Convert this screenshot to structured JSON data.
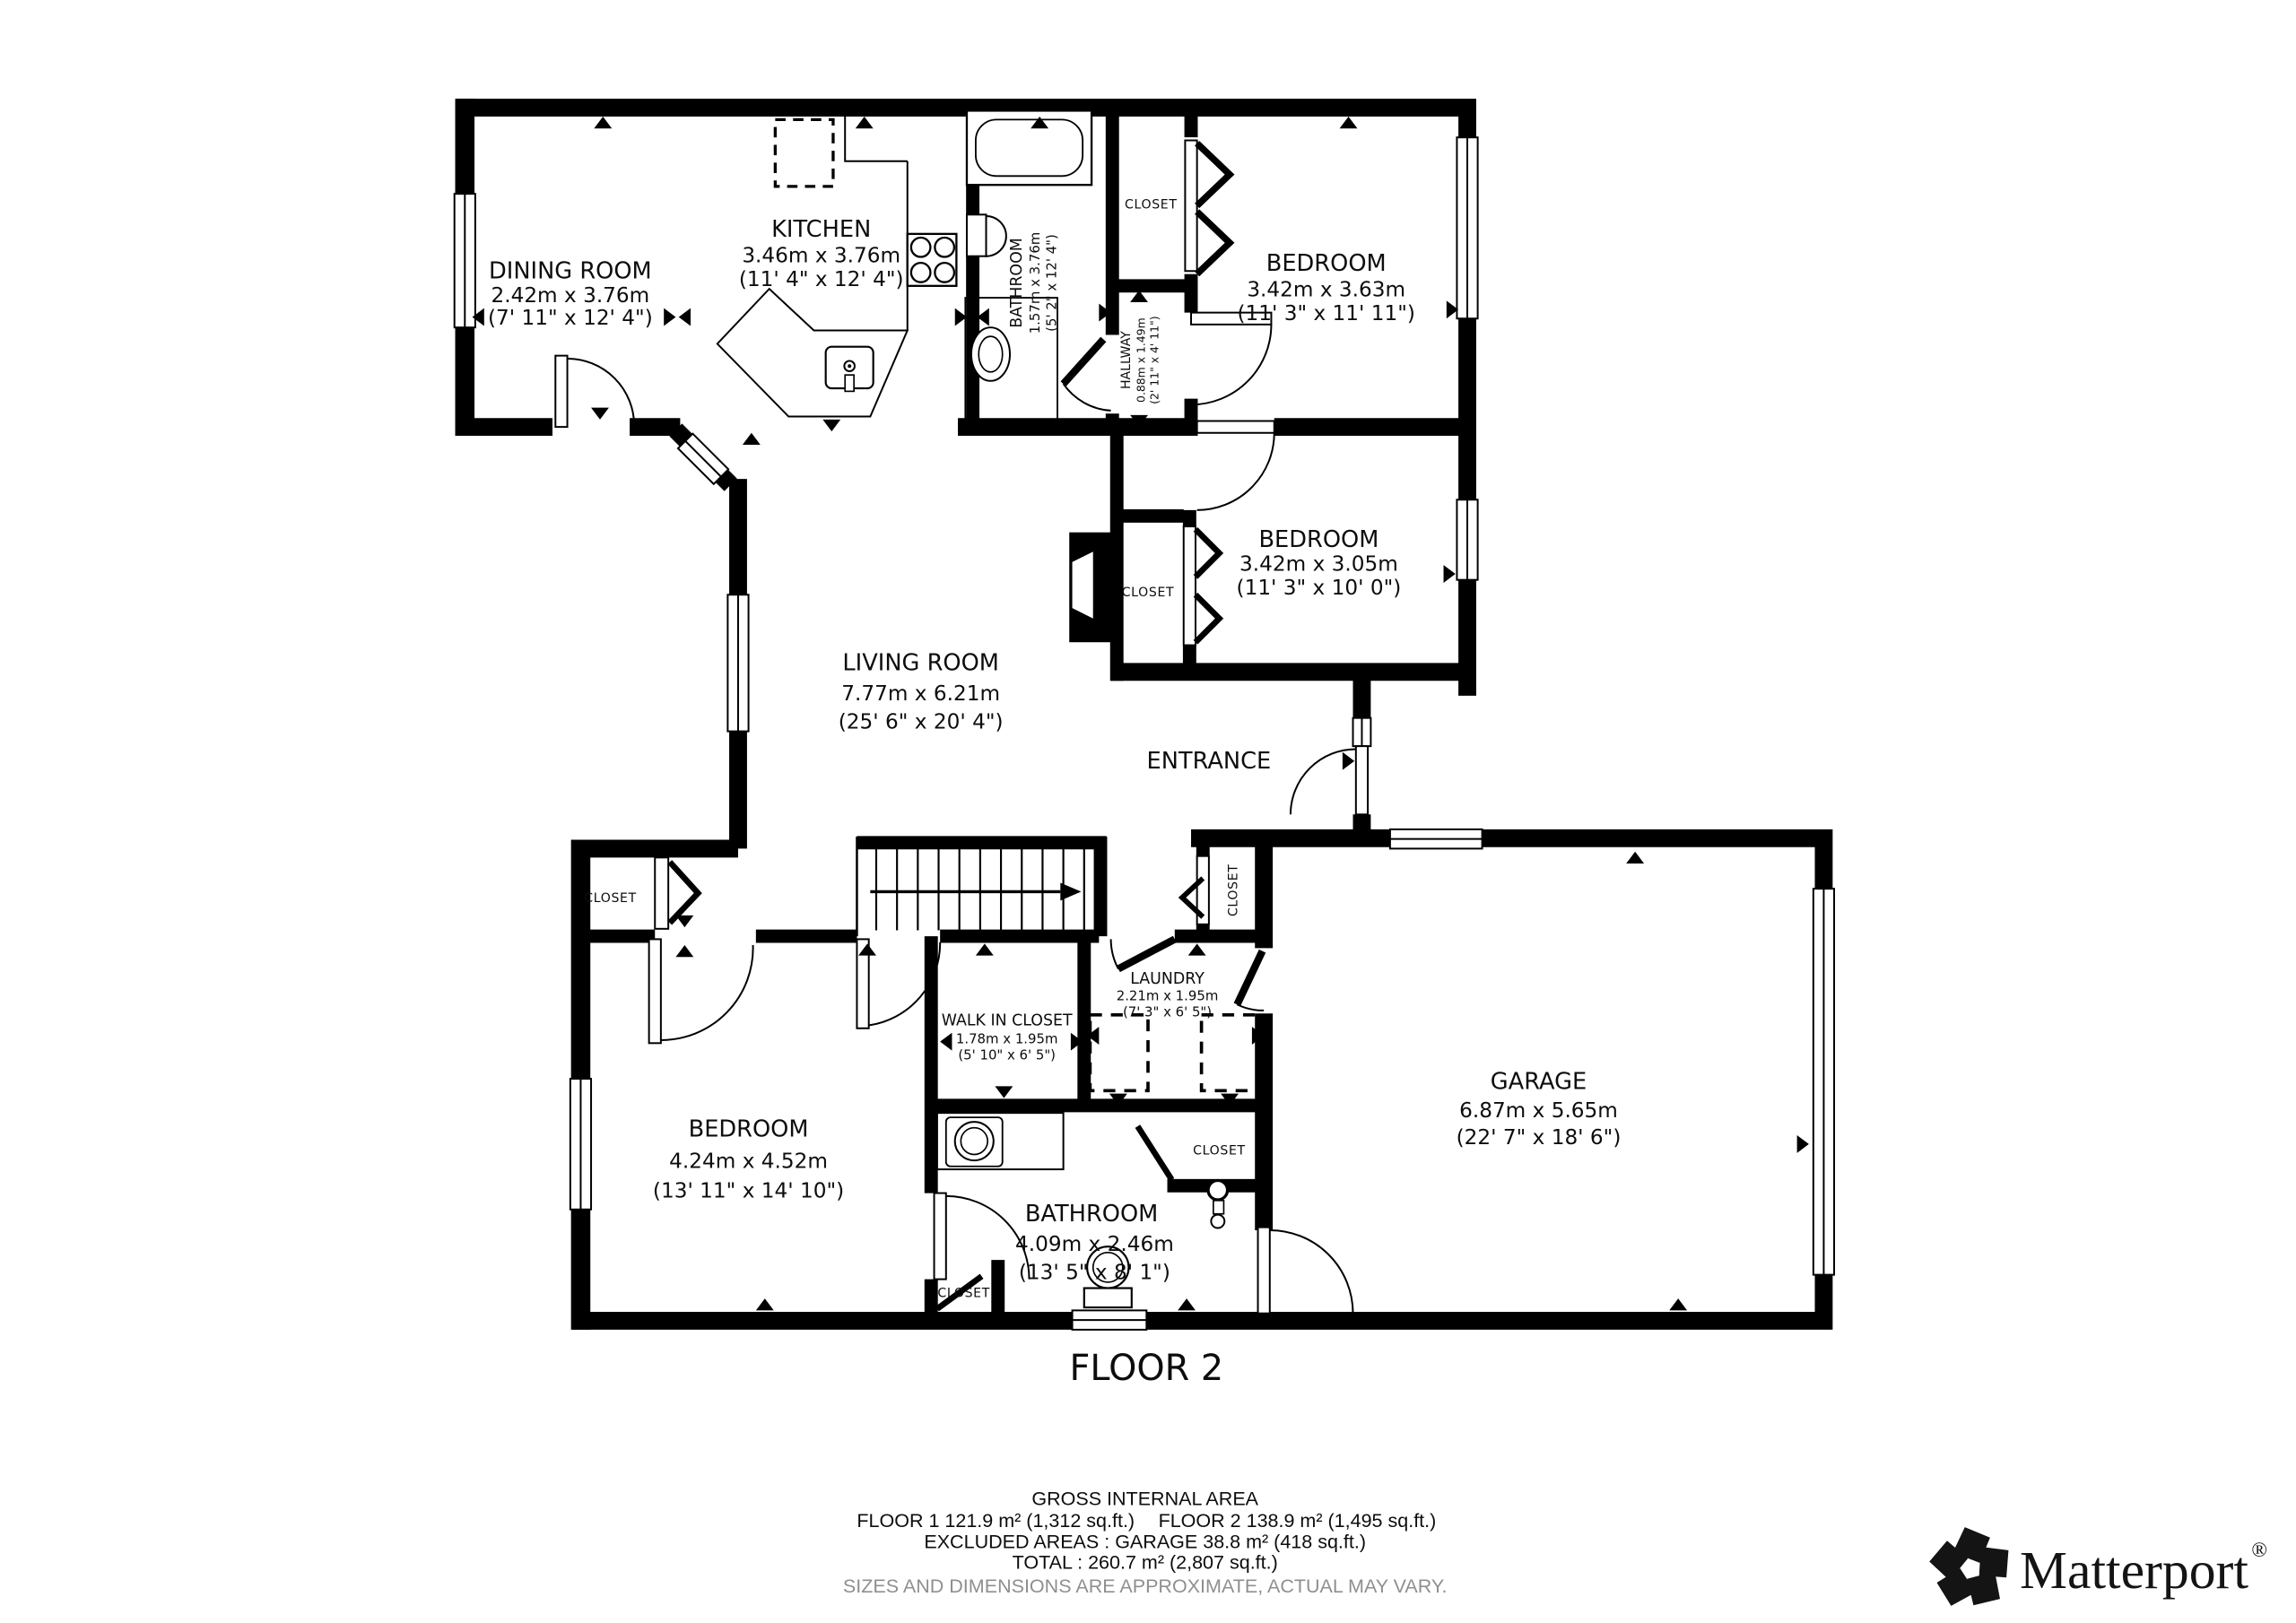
{
  "floor_plan": {
    "floor_title": "FLOOR 2",
    "closet_label": "CLOSET",
    "rooms": {
      "dining_room": {
        "name": "DINING ROOM",
        "metric": "2.42m x 3.76m",
        "imperial": "(7' 11\" x 12' 4\")"
      },
      "kitchen": {
        "name": "KITCHEN",
        "metric": "3.46m x 3.76m",
        "imperial": "(11' 4\" x 12' 4\")"
      },
      "bathroom_top": {
        "name": "BATHROOM",
        "metric": "1.57m x 3.76m",
        "imperial": "(5' 2\" x 12' 4\")"
      },
      "hallway": {
        "name": "HALLWAY",
        "metric": "0.88m x 1.49m",
        "imperial": "(2' 11\" x 4' 11\")"
      },
      "bedroom_1": {
        "name": "BEDROOM",
        "metric": "3.42m x 3.63m",
        "imperial": "(11' 3\" x 11' 11\")"
      },
      "bedroom_2": {
        "name": "BEDROOM",
        "metric": "3.42m x 3.05m",
        "imperial": "(11' 3\" x 10' 0\")"
      },
      "living_room": {
        "name": "LIVING ROOM",
        "metric": "7.77m x 6.21m",
        "imperial": "(25' 6\" x 20' 4\")"
      },
      "entrance": {
        "name": "ENTRANCE"
      },
      "walk_in_closet": {
        "name": "WALK IN CLOSET",
        "metric": "1.78m x 1.95m",
        "imperial": "(5' 10\" x 6' 5\")"
      },
      "laundry": {
        "name": "LAUNDRY",
        "metric": "2.21m x 1.95m",
        "imperial": "(7' 3\" x 6' 5\")"
      },
      "bedroom_3": {
        "name": "BEDROOM",
        "metric": "4.24m x 4.52m",
        "imperial": "(13' 11\" x 14' 10\")"
      },
      "garage": {
        "name": "GARAGE",
        "metric": "6.87m x 5.65m",
        "imperial": "(22' 7\" x 18' 6\")"
      },
      "bathroom_bottom": {
        "name": "BATHROOM",
        "metric": "4.09m x 2.46m",
        "imperial": "(13' 5\" x 8' 1\")"
      }
    }
  },
  "footer": {
    "title": "GROSS INTERNAL AREA",
    "floor1_part": "FLOOR 1 121.9 m² (1,312 sq.ft.)",
    "floor2_part": "FLOOR 2 138.9 m² (1,495 sq.ft.)",
    "excluded_line": "EXCLUDED AREAS :  GARAGE 38.8 m² (418 sq.ft.)",
    "total_line": "TOTAL :  260.7 m² (2,807 sq.ft.)",
    "disclaimer": "SIZES AND DIMENSIONS ARE APPROXIMATE, ACTUAL MAY VARY."
  },
  "branding": {
    "logo_text": "Matterport",
    "registered_mark": "®"
  }
}
